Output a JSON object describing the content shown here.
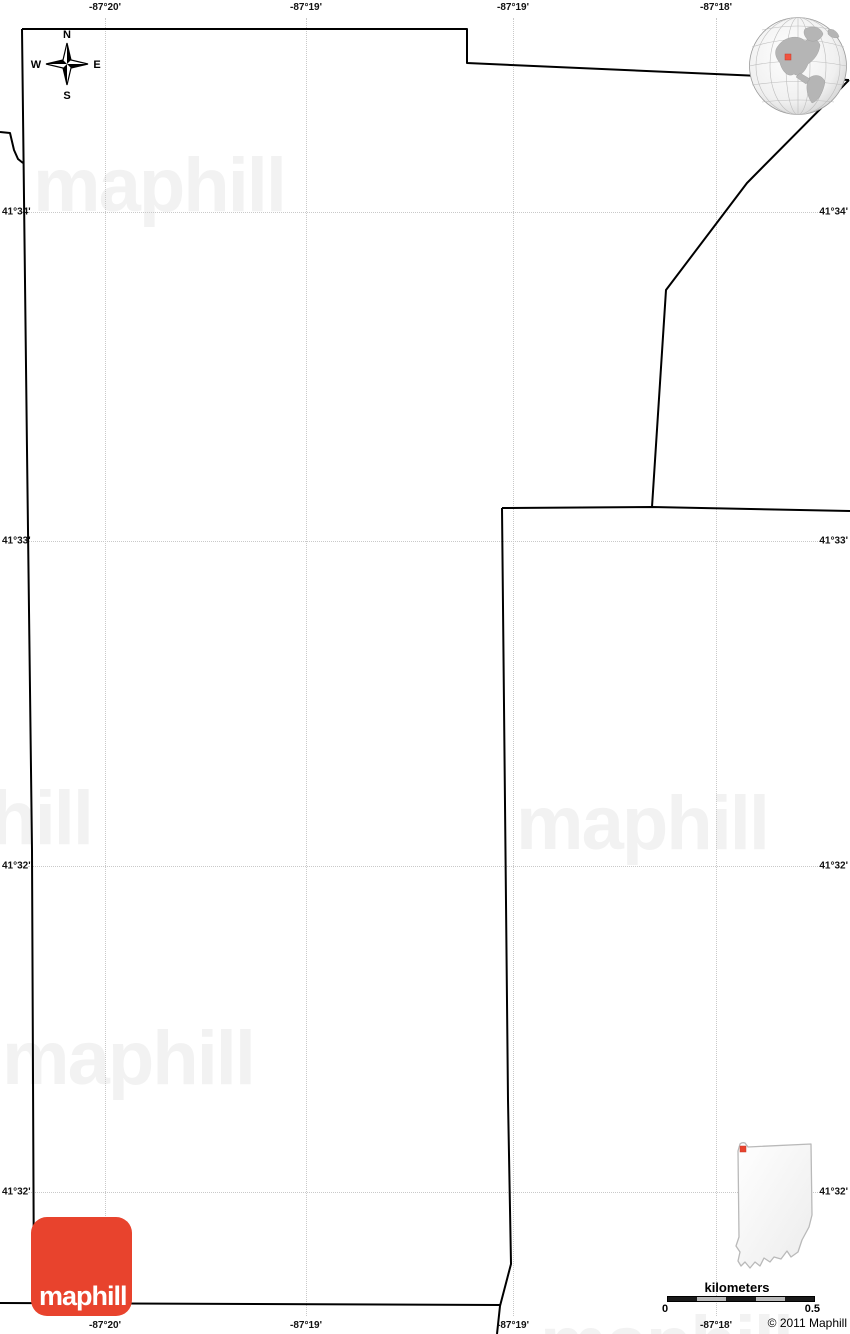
{
  "compass": {
    "north": "N",
    "south": "S",
    "east": "E",
    "west": "W"
  },
  "coordinates": {
    "meridians": [
      {
        "x": 105,
        "label": "-87°20'"
      },
      {
        "x": 306,
        "label": "-87°19'"
      },
      {
        "x": 513,
        "label": "-87°19'"
      },
      {
        "x": 716,
        "label": "-87°18'"
      }
    ],
    "parallels": [
      {
        "y": 212,
        "label": "41°34'"
      },
      {
        "y": 541,
        "label": "41°33'"
      },
      {
        "y": 866,
        "label": "41°32'"
      },
      {
        "y": 1192,
        "label": "41°32'"
      }
    ]
  },
  "boundaries": {
    "color": "#000000",
    "stroke_width": 2,
    "polylines": [
      {
        "name": "north-border",
        "points": [
          [
            22,
            29
          ],
          [
            467,
            29
          ],
          [
            467,
            63
          ],
          [
            849,
            80
          ]
        ]
      },
      {
        "name": "northeast-diagonal",
        "points": [
          [
            849,
            80
          ],
          [
            747,
            183
          ],
          [
            666,
            290
          ],
          [
            652,
            507
          ]
        ]
      },
      {
        "name": "west-border",
        "points": [
          [
            22,
            29
          ],
          [
            27,
            450
          ],
          [
            32,
            850
          ],
          [
            34,
            1303
          ]
        ]
      },
      {
        "name": "south-border",
        "points": [
          [
            0,
            1303
          ],
          [
            500,
            1305
          ]
        ]
      },
      {
        "name": "west-notch",
        "points": [
          [
            0,
            132
          ],
          [
            10,
            133
          ],
          [
            14,
            150
          ],
          [
            18,
            159
          ],
          [
            23,
            163
          ]
        ]
      },
      {
        "name": "parcel-top-border",
        "points": [
          [
            502,
            508
          ],
          [
            652,
            507
          ],
          [
            850,
            511
          ]
        ]
      },
      {
        "name": "parcel-west-border",
        "points": [
          [
            502,
            508
          ],
          [
            508,
            1100
          ],
          [
            511,
            1264
          ],
          [
            500,
            1306
          ],
          [
            497,
            1334
          ]
        ]
      }
    ]
  },
  "watermarks": {
    "text": "maphill",
    "color": "#f2f2f2",
    "positions": [
      {
        "x": 33,
        "y": 148
      },
      {
        "x": -160,
        "y": 781
      },
      {
        "x": 516,
        "y": 786
      },
      {
        "x": 2,
        "y": 1021
      },
      {
        "x": 540,
        "y": 1306
      }
    ]
  },
  "logo": {
    "label": "maphill",
    "bg": "#e8432d"
  },
  "locator_globe": {
    "marker_color": "#f0533f",
    "land_color": "#b5b5b5"
  },
  "region_inset": {
    "marker_color": "#e8432d"
  },
  "scale_bar": {
    "title": "kilometers",
    "min": "0",
    "max": "0.5",
    "segments": [
      "#1a1a1a",
      "#b9b9b9",
      "#1a1a1a",
      "#b9b9b9",
      "#1a1a1a"
    ]
  },
  "copyright": "© 2011 Maphill"
}
